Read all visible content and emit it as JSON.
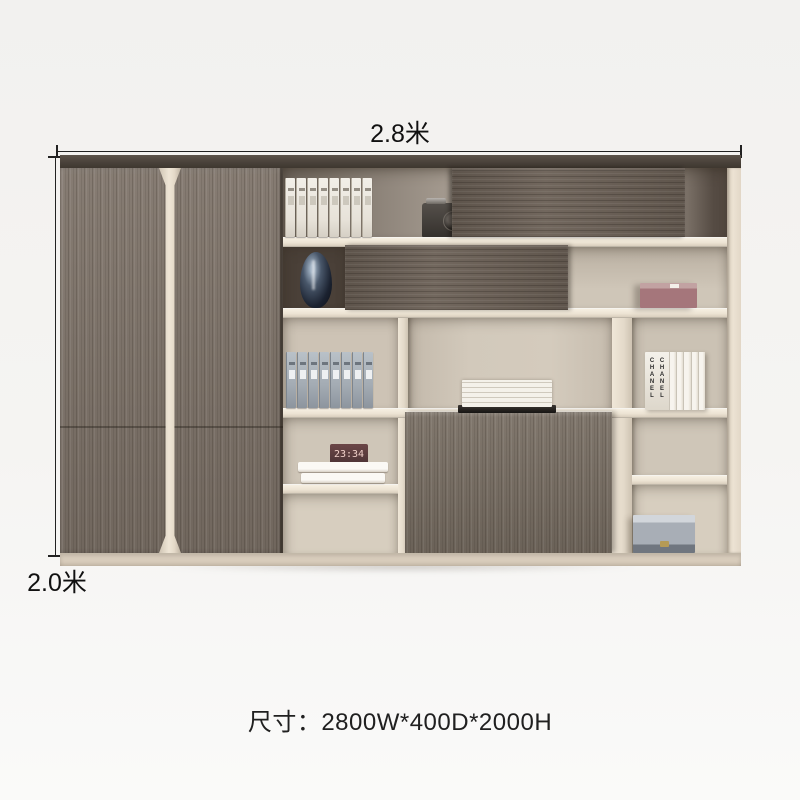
{
  "annotations": {
    "width_label": "2.8米",
    "height_label": "2.0米",
    "caption": "尺寸：2800W*400D*2000H"
  },
  "cabinet": {
    "description": "wood-grain office file cabinet with open shelving",
    "colors": {
      "background": "#f4f3f1",
      "top_panel": "#4a423b",
      "door_wood": "#7d7268",
      "sliding_door_wood": "#6a5f55",
      "big_door_wood": "#776d62",
      "frame_cream": "#e8decf",
      "shelf_cream": "#efe7d8",
      "back_light": "#cdc3b5",
      "back_dark": "#4a4038",
      "handle_strip": "#e9dfd0",
      "annotation_text": "#111111"
    },
    "items": {
      "binders_top": {
        "name": "white file binders",
        "count": 8
      },
      "binders_mid": {
        "name": "gray-blue file binders",
        "count": 8
      },
      "camera": {
        "name": "vintage camera"
      },
      "vase": {
        "name": "dark glossy vase"
      },
      "pink_box": {
        "name": "dusty-pink storage box"
      },
      "book_stack": {
        "name": "stacked white books on black book"
      },
      "chanel_books": {
        "spine_text": "CHANEL",
        "spine_count": 5
      },
      "clock": {
        "display": "23:34"
      },
      "books_row4": {
        "name": "two white books"
      },
      "gray_box": {
        "name": "silver-gray storage box"
      }
    }
  }
}
